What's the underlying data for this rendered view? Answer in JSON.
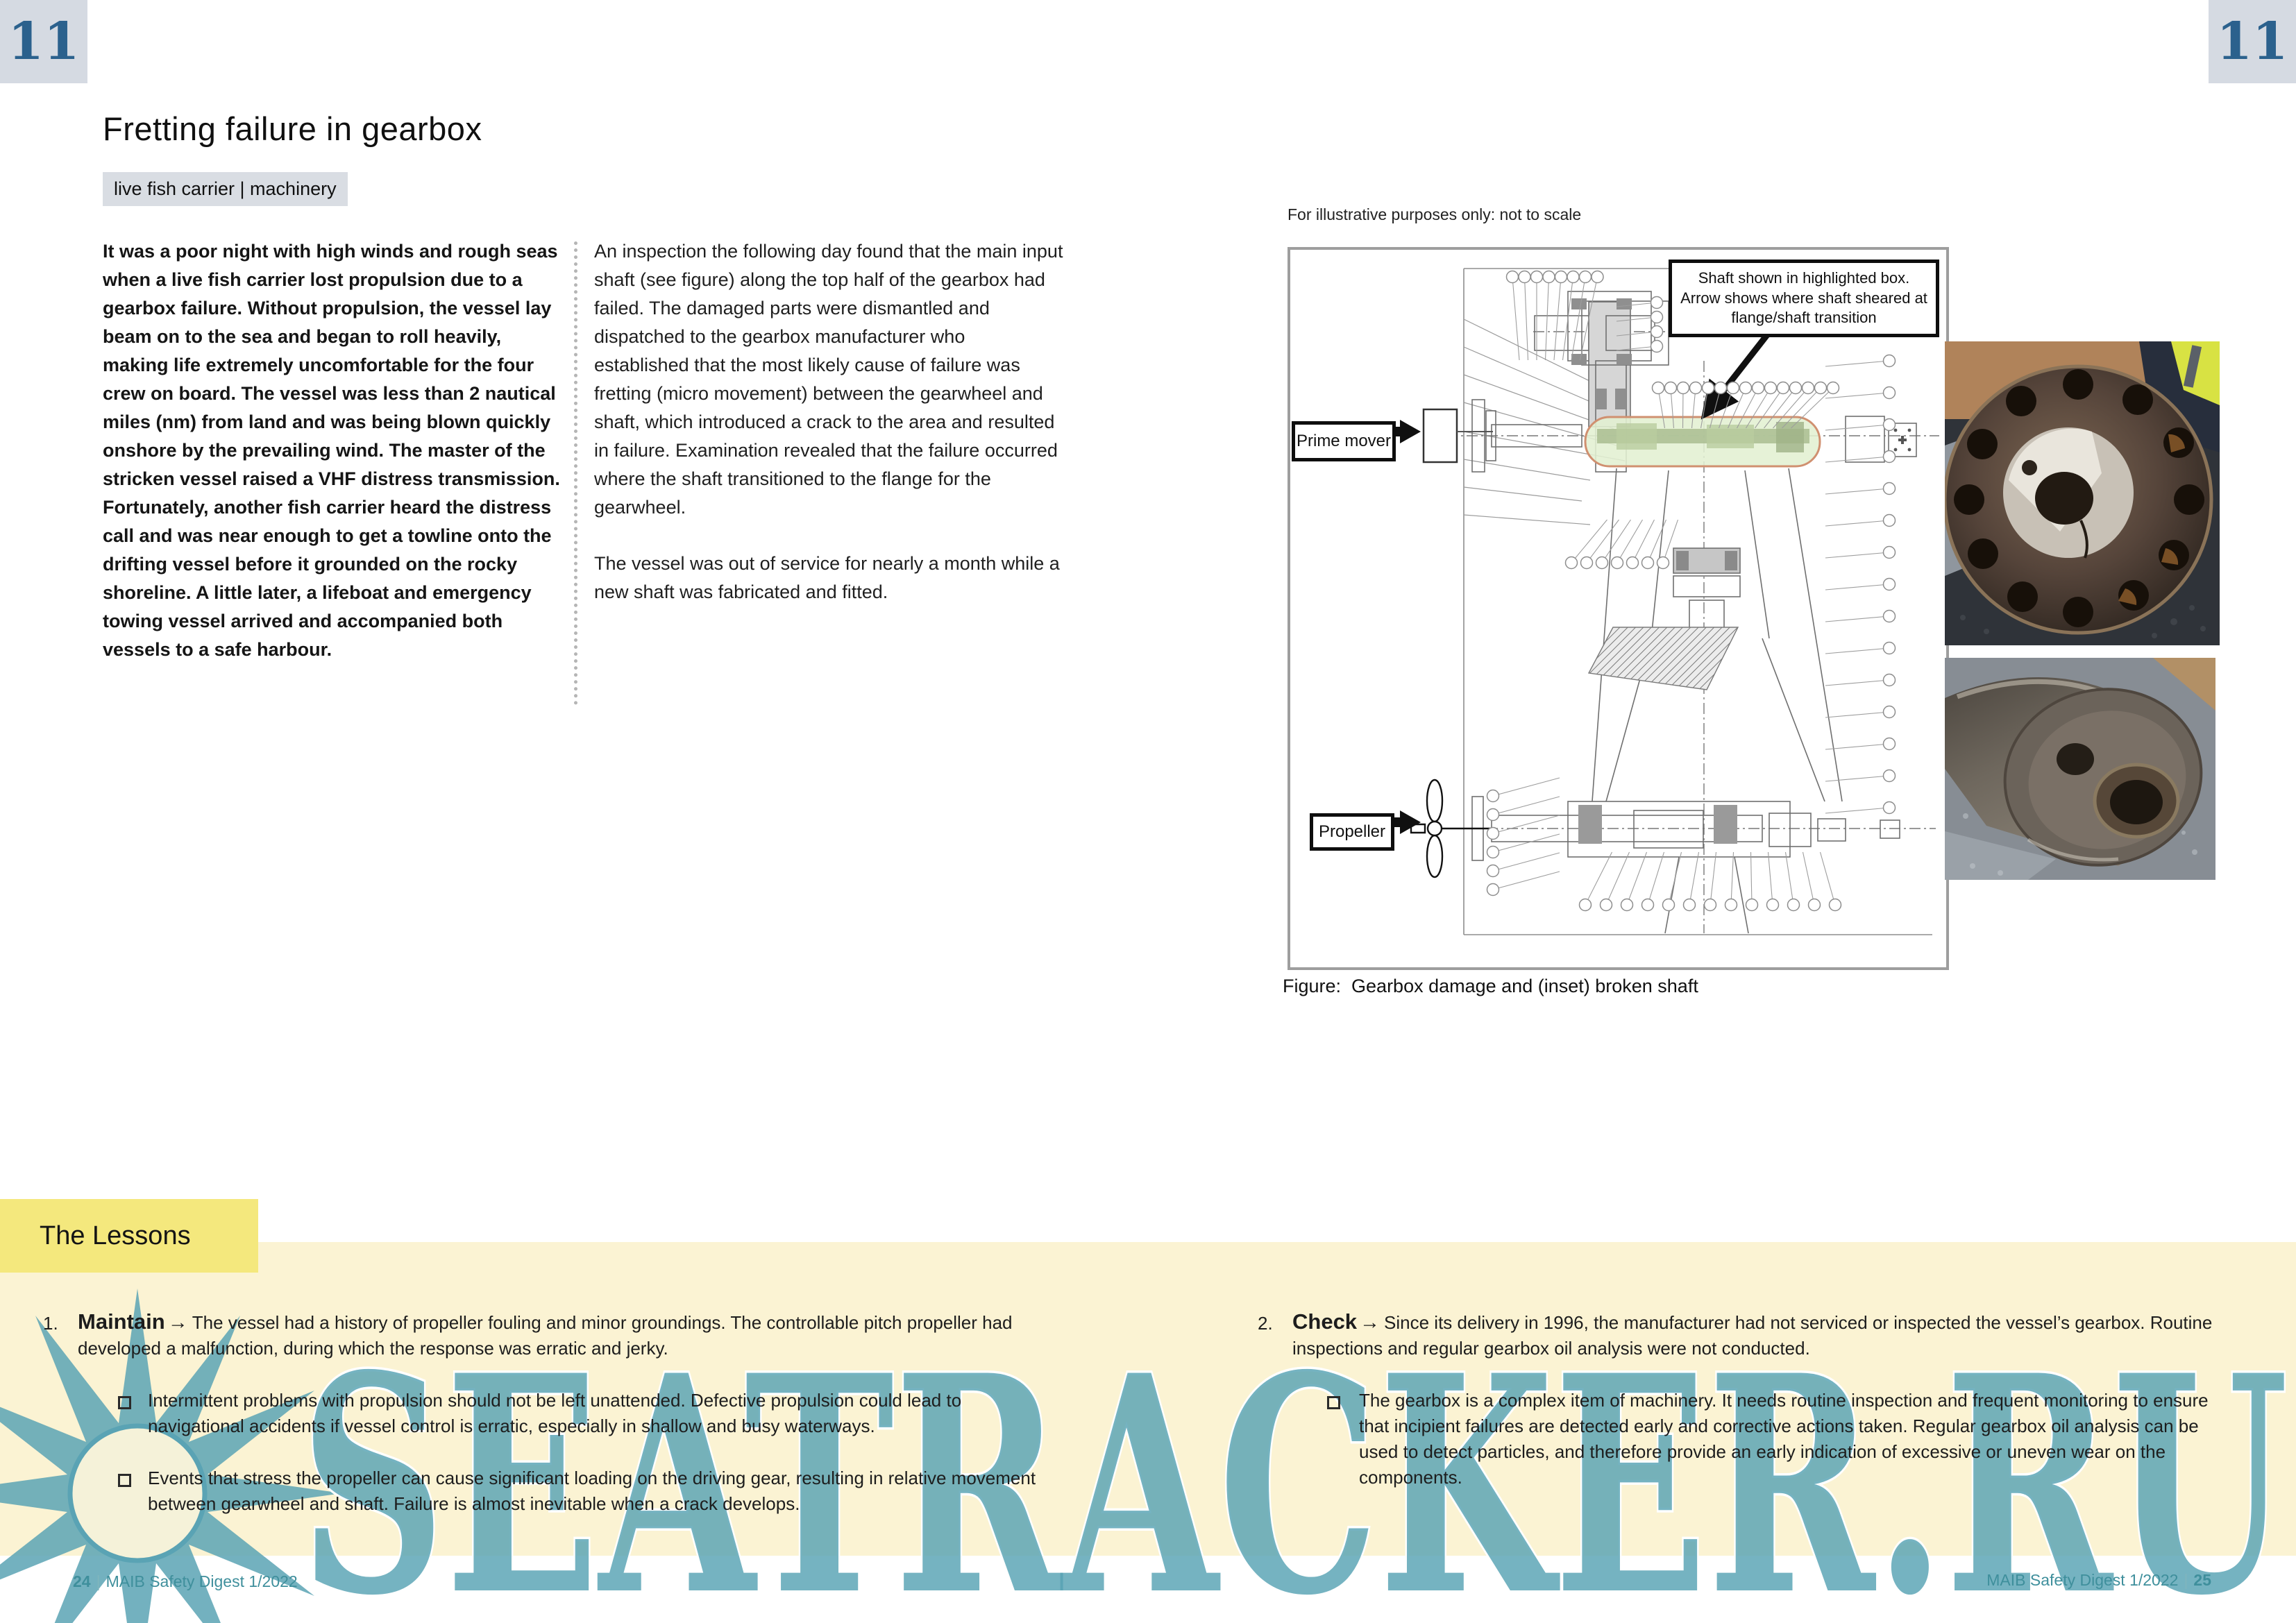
{
  "page": {
    "left_page_badge": "11",
    "right_page_badge": "11",
    "title": "Fretting failure in gearbox",
    "tag": "live fish carrier | machinery",
    "footer_left": {
      "page": "24",
      "sep": "|",
      "text": "MAIB Safety Digest 1/2022"
    },
    "footer_right": {
      "text": "MAIB Safety Digest 1/2022",
      "sep": "|",
      "page": "25"
    }
  },
  "story": {
    "column1": "It was a poor night with high winds and rough seas when a live fish carrier lost propulsion due to a gearbox failure. Without propulsion, the vessel lay beam on to the sea and began to roll heavily, making life extremely uncomfortable for the four crew on board. The vessel was less than 2 nautical miles (nm) from land and was being blown quickly onshore by the prevailing wind. The master of the stricken vessel raised a VHF distress transmission. Fortunately, another fish carrier heard the distress call and was near enough to get a towline onto the drifting vessel before it grounded on the rocky shoreline. A little later, a lifeboat and emergency towing vessel arrived and accompanied both vessels to a safe harbour.",
    "column2_para1": "An inspection the following day found that the main input shaft (see figure) along the top half of the gearbox had failed. The damaged parts were dismantled and dispatched to the gearbox manufacturer who established that the most likely cause of failure was fretting (micro movement) between the gearwheel and shaft, which introduced a crack to the area and resulted in failure. Examination revealed that the failure occurred where the shaft transitioned to the flange for the gearwheel.",
    "column2_para2": "The vessel was out of service for nearly a month while a new shaft was fabricated and fitted."
  },
  "figure": {
    "note": "For illustrative purposes only: not to scale",
    "annotation": "Shaft shown in highlighted box. Arrow shows where shaft sheared at flange/shaft transition",
    "label_prime_mover": "Prime mover",
    "label_propeller": "Propeller",
    "caption": "Figure:  Gearbox damage and (inset) broken shaft"
  },
  "lessons": {
    "heading": "The Lessons",
    "items": [
      {
        "number": "1.",
        "keyword": "Maintain",
        "arrow": "→",
        "text": "The vessel had a history of propeller fouling and minor groundings. The controllable pitch propeller had developed a malfunction, during which the response was erratic and jerky.",
        "bullets": [
          "Intermittent problems with propulsion should not be left unattended. Defective propulsion could lead to navigational accidents if vessel control is erratic, especially in shallow and busy waterways.",
          "Events that stress the propeller can cause significant loading on the driving gear, resulting in relative movement between gearwheel and shaft. Failure is almost inevitable when a crack develops."
        ]
      },
      {
        "number": "2.",
        "keyword": "Check",
        "arrow": "→",
        "text": "Since its delivery in 1996, the manufacturer had not serviced or inspected the vessel’s gearbox. Routine inspections and regular gearbox oil analysis were not conducted.",
        "bullets": [
          "The gearbox is a complex item of machinery. It needs routine inspection and frequent monitoring to ensure that incipient failures are detected early and corrective actions taken. Regular gearbox oil analysis can be used to detect particles, and therefore provide an early indication of excessive or uneven wear on the components."
        ]
      }
    ]
  },
  "watermark": {
    "text": "SEATRACKER.RU",
    "color": "#57a2b3"
  },
  "colors": {
    "badge_bg": "#d5dae2",
    "badge_number": "#2b618d",
    "lessons_header_bg": "#f4e87d",
    "lessons_panel_bg": "#fbf3d3",
    "highlight_green": "#e3f0d2",
    "highlight_border": "#d09070",
    "footer_teal": "#3f8f9c",
    "watermark_teal": "#57a2b3"
  }
}
